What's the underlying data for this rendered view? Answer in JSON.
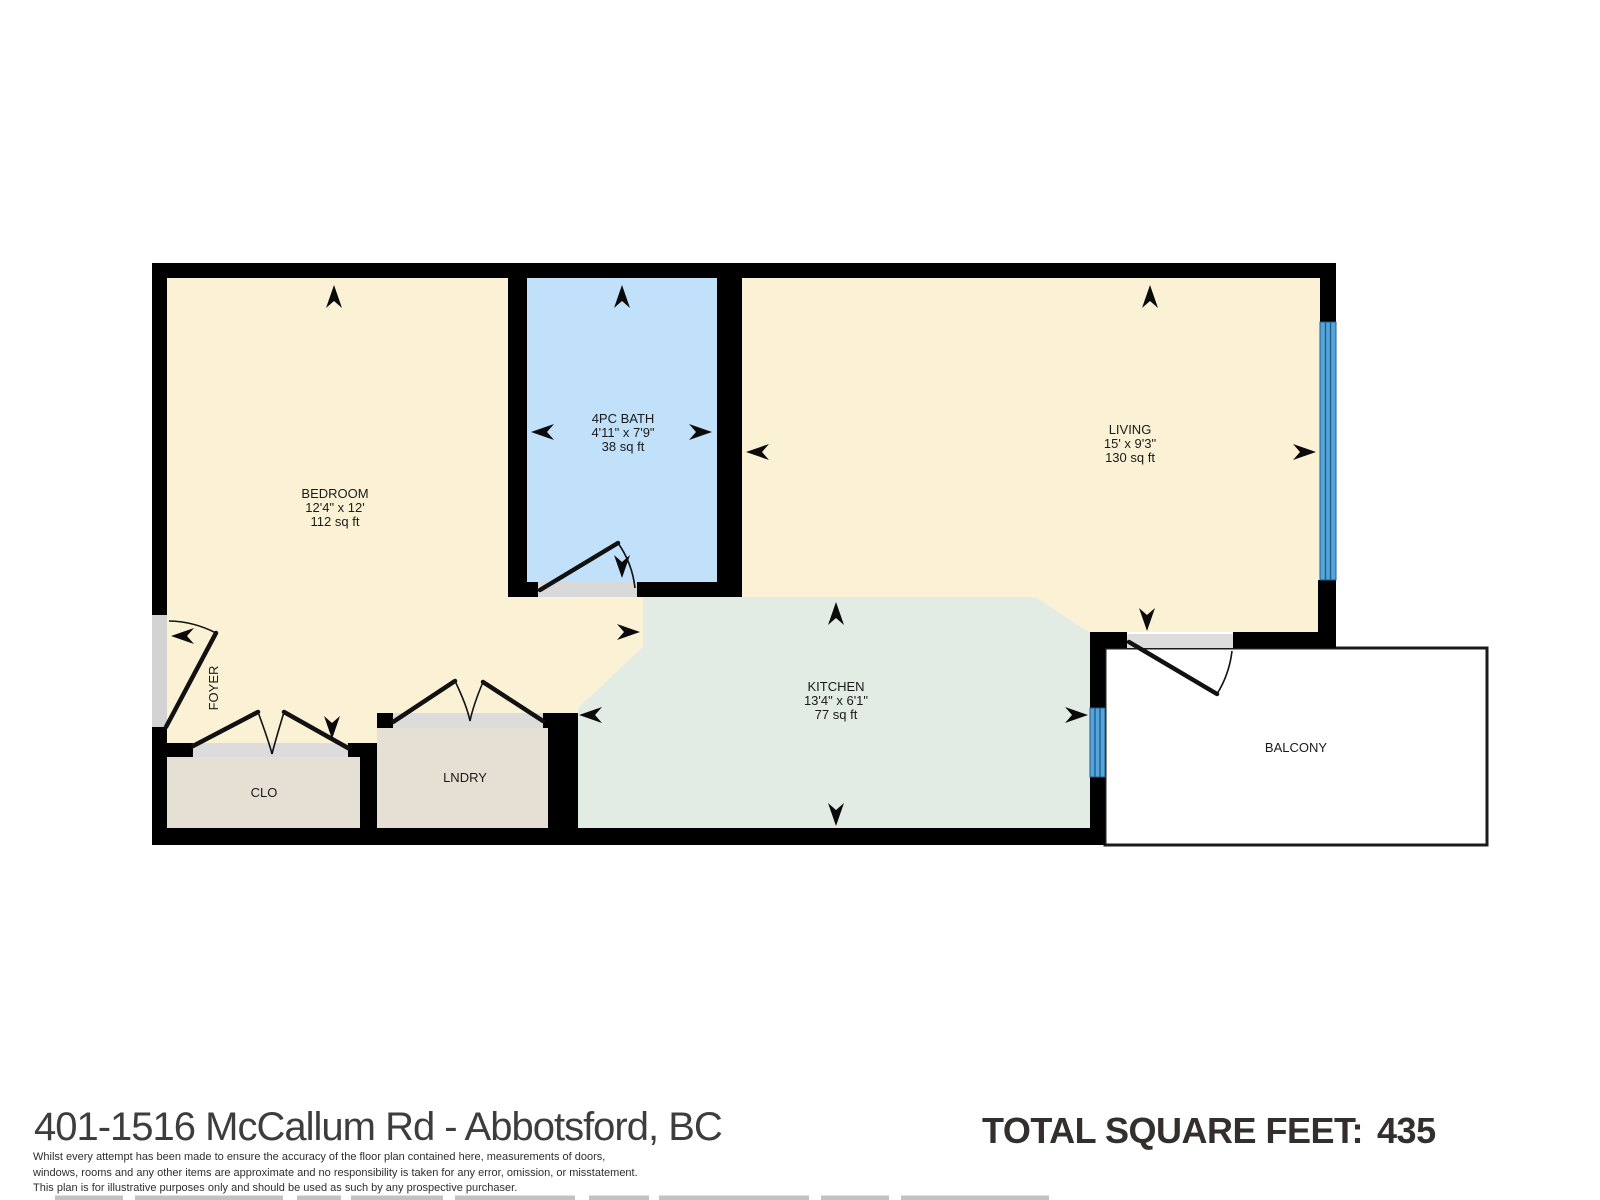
{
  "title": "401-1516 McCallum Rd - Abbotsford, BC",
  "total": {
    "label": "TOTAL SQUARE FEET:",
    "value": "435"
  },
  "disclaimer": {
    "line1": "Whilst every attempt has been made to ensure the accuracy of the floor plan contained here, measurements of doors,",
    "line2": "windows, rooms and any other items are approximate and no responsibility is taken for any error, omission, or misstatement.",
    "line3": "This plan is for illustrative purposes only and should be used as such by any prospective purchaser."
  },
  "rooms": {
    "bedroom": {
      "name": "BEDROOM",
      "dims": "12'4\" x 12'",
      "area": "112 sq ft"
    },
    "bath": {
      "name": "4PC BATH",
      "dims": "4'11\" x 7'9\"",
      "area": "38 sq ft"
    },
    "living": {
      "name": "LIVING",
      "dims": "15' x 9'3\"",
      "area": "130 sq ft"
    },
    "kitchen": {
      "name": "KITCHEN",
      "dims": "13'4\" x 6'1\"",
      "area": "77 sq ft"
    },
    "closet": {
      "name": "CLO"
    },
    "laundry": {
      "name": "LNDRY"
    },
    "foyer": {
      "name": "FOYER"
    },
    "balcony": {
      "name": "BALCONY"
    }
  },
  "colors": {
    "floor_beige": "#FBF2D6",
    "floor_blue": "#C0E1F9",
    "floor_green": "#E2EBE4",
    "floor_tan": "#E6DFD3",
    "balcony_fill": "#FFFFFF",
    "window_blue": "#55A5DB",
    "window_line": "#1F5E8C",
    "wall_black": "#000000",
    "threshold_gray": "#D8D8D8"
  }
}
